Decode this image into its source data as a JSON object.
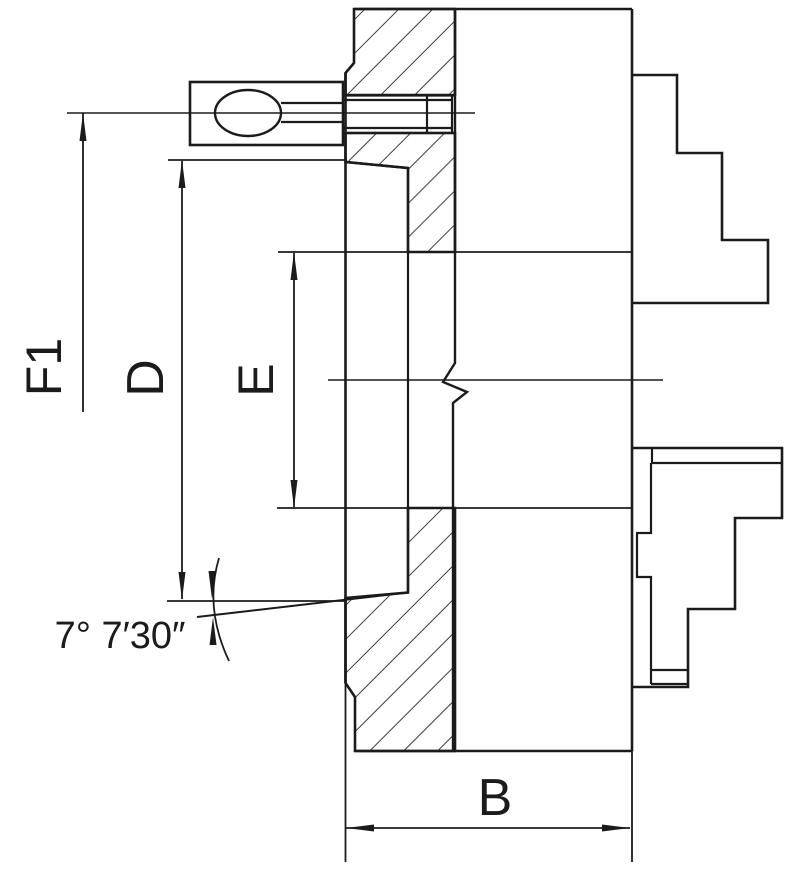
{
  "drawing": {
    "view": "section-view-of-lathe-chuck",
    "background": "#ffffff",
    "line_color": "#1b1b1b"
  },
  "dimensions": {
    "f1": {
      "label": "F1",
      "orientation": "vertical-rotated"
    },
    "d": {
      "label": "D",
      "orientation": "vertical-rotated"
    },
    "e": {
      "label": "E",
      "orientation": "vertical-rotated"
    },
    "b": {
      "label": "B",
      "orientation": "horizontal"
    },
    "taper_angle": {
      "label": "7° 7′30″"
    }
  }
}
